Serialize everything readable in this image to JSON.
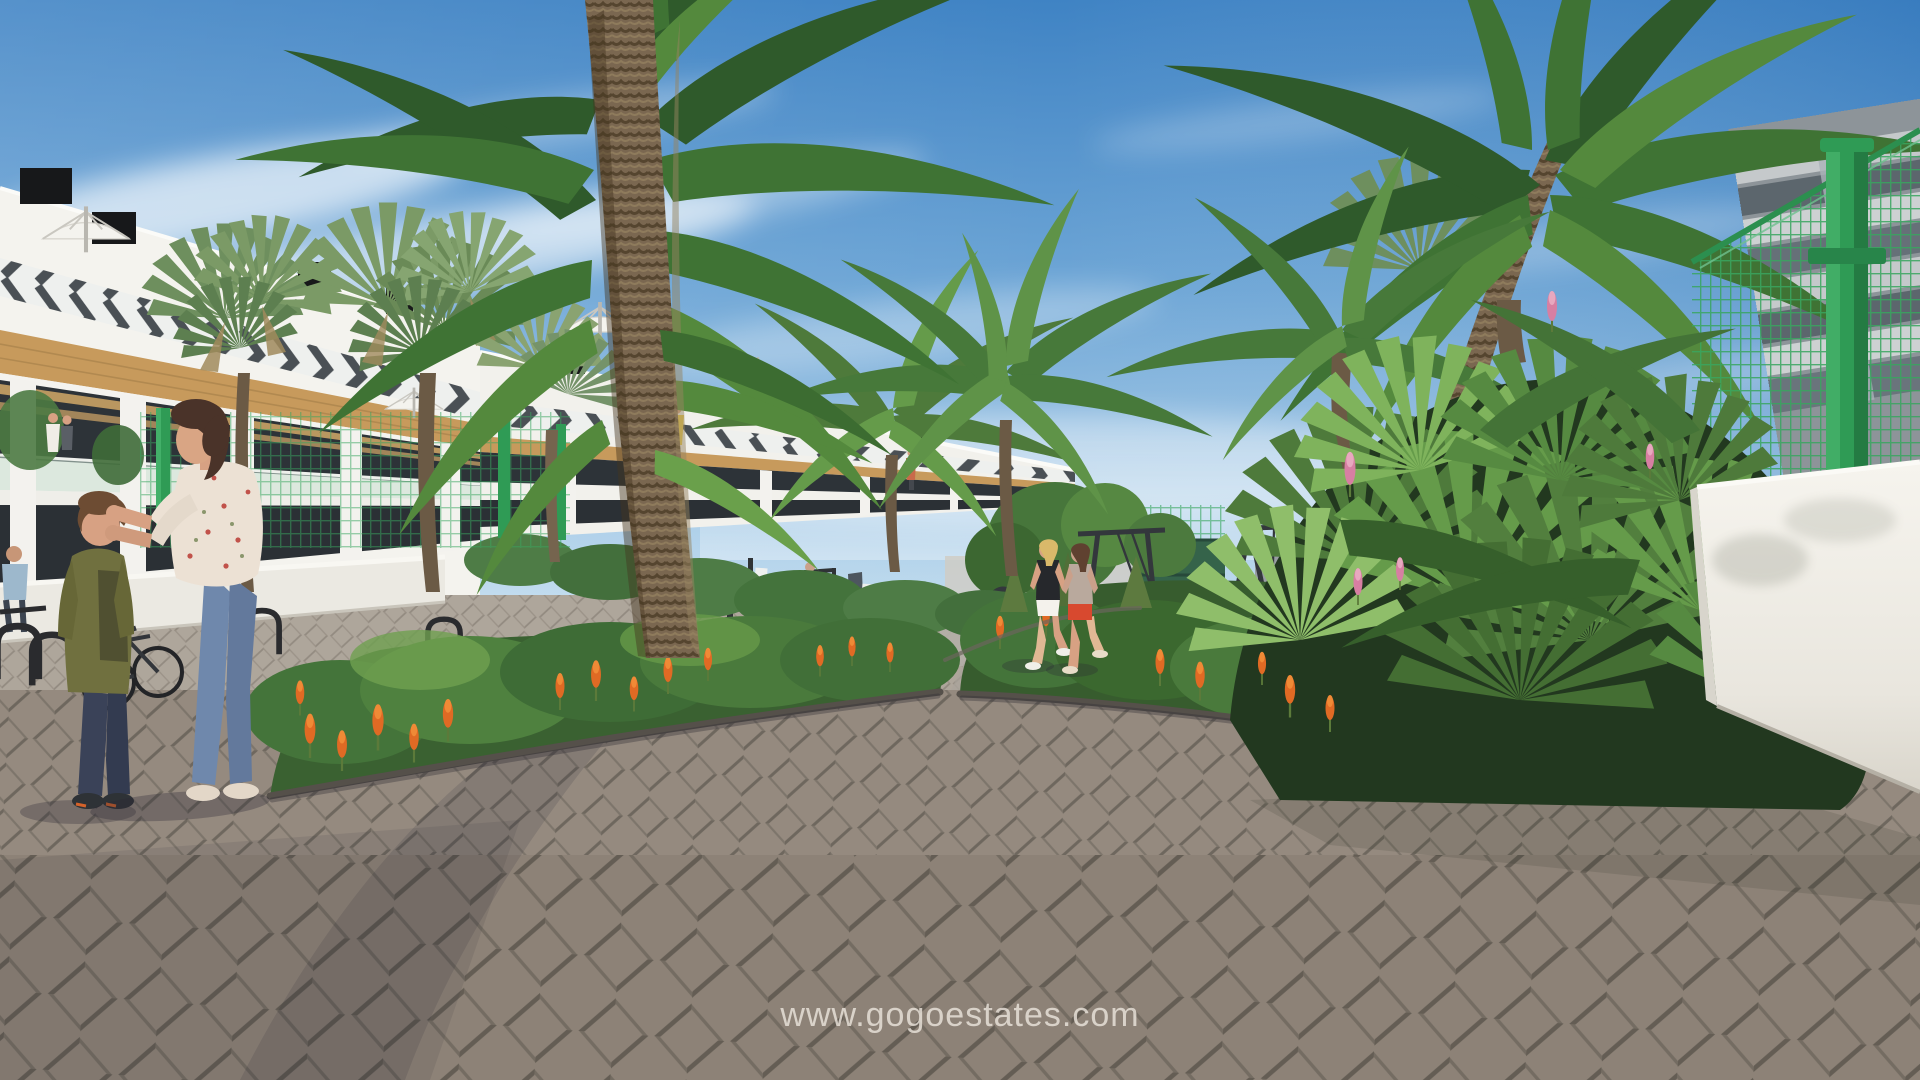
{
  "watermark": {
    "text": "www.gogoestates.com"
  },
  "scene": {
    "type": "architectural-render",
    "subject": "residential complex courtyard with palm trees, gardens, playground and paved walkways",
    "palette": {
      "sky_top": "#3f83c4",
      "sky_horizon": "#c3ddef",
      "cloud_white": "#ffffff",
      "building_white": "#f4f3ee",
      "chevron_gray": "#4a5055",
      "wood_accent": "#c79a5c",
      "window_dark": "#2d3338",
      "balcony_glass": "#c9dfd2",
      "foliage_dark": "#2c4f28",
      "foliage_mid": "#44743a",
      "foliage_light": "#6fa050",
      "palm_trunk": "#7a6750",
      "flower_orange": "#e06a24",
      "flower_pink": "#d77fa2",
      "paving_gray": "#94897e",
      "paving_joint": "#6e675e",
      "fence_green": "#2f9b55",
      "wall_white": "#f2f0ea",
      "skin": "#d7a183",
      "denim_blue": "#6f88ac"
    }
  }
}
